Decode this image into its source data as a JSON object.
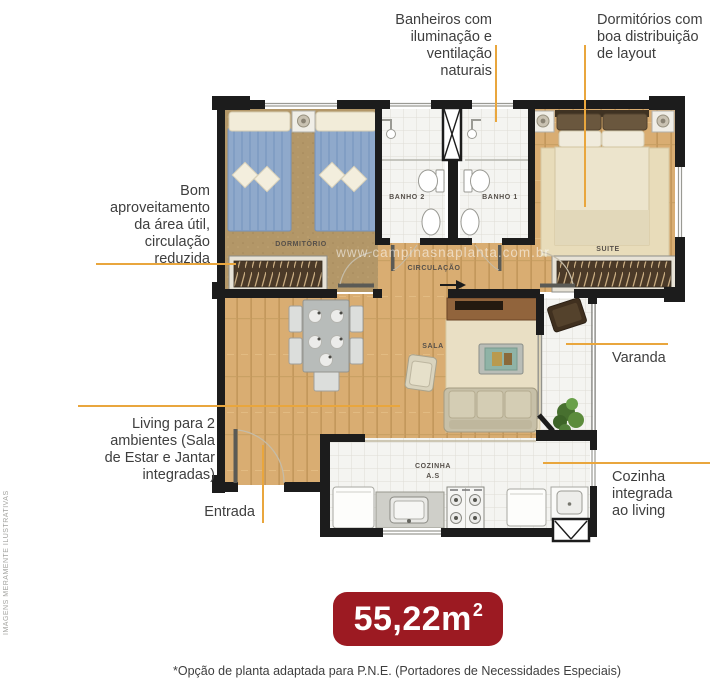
{
  "side_note": "IMAGENS MERAMENTE ILUSTRATIVAS",
  "watermark": "www.campinasnaplanta.com.br",
  "callouts": {
    "banheiros": {
      "lines": [
        "Banheiros com",
        "iluminação e",
        "ventilação",
        "naturais"
      ]
    },
    "dormitorios": {
      "lines": [
        "Dormitórios com",
        "boa distribuição",
        "de layout"
      ]
    },
    "aproveitamento": {
      "lines": [
        "Bom",
        "aproveitamento",
        "da área útil,",
        "circulação",
        "reduzida"
      ]
    },
    "living": {
      "lines": [
        "Living para 2",
        "ambientes (Sala",
        "de Estar e Jantar",
        "integradas)"
      ]
    },
    "entrada": {
      "label": "Entrada"
    },
    "varanda": {
      "label": "Varanda"
    },
    "cozinha": {
      "lines": [
        "Cozinha",
        "integrada",
        "ao living"
      ]
    }
  },
  "rooms": {
    "dormitorio": "DORMITÓRIO",
    "banho2": "BANHO 2",
    "banho1": "BANHO 1",
    "suite": "SUITE",
    "circulacao": "CIRCULAÇÃO",
    "sala": "SALA",
    "cozinha": "COZINHA",
    "cozinha2": "A.S"
  },
  "area_badge": {
    "number": "55,22m",
    "superscript": "2"
  },
  "footnote": "*Opção de planta adaptada para P.N.E. (Portadores de Necessidades Especiais)",
  "colors": {
    "accent_line": "#e9a63d",
    "badge_red": "#9c1a22",
    "wall": "#1c1c1c",
    "wood": "#d9ad72"
  }
}
